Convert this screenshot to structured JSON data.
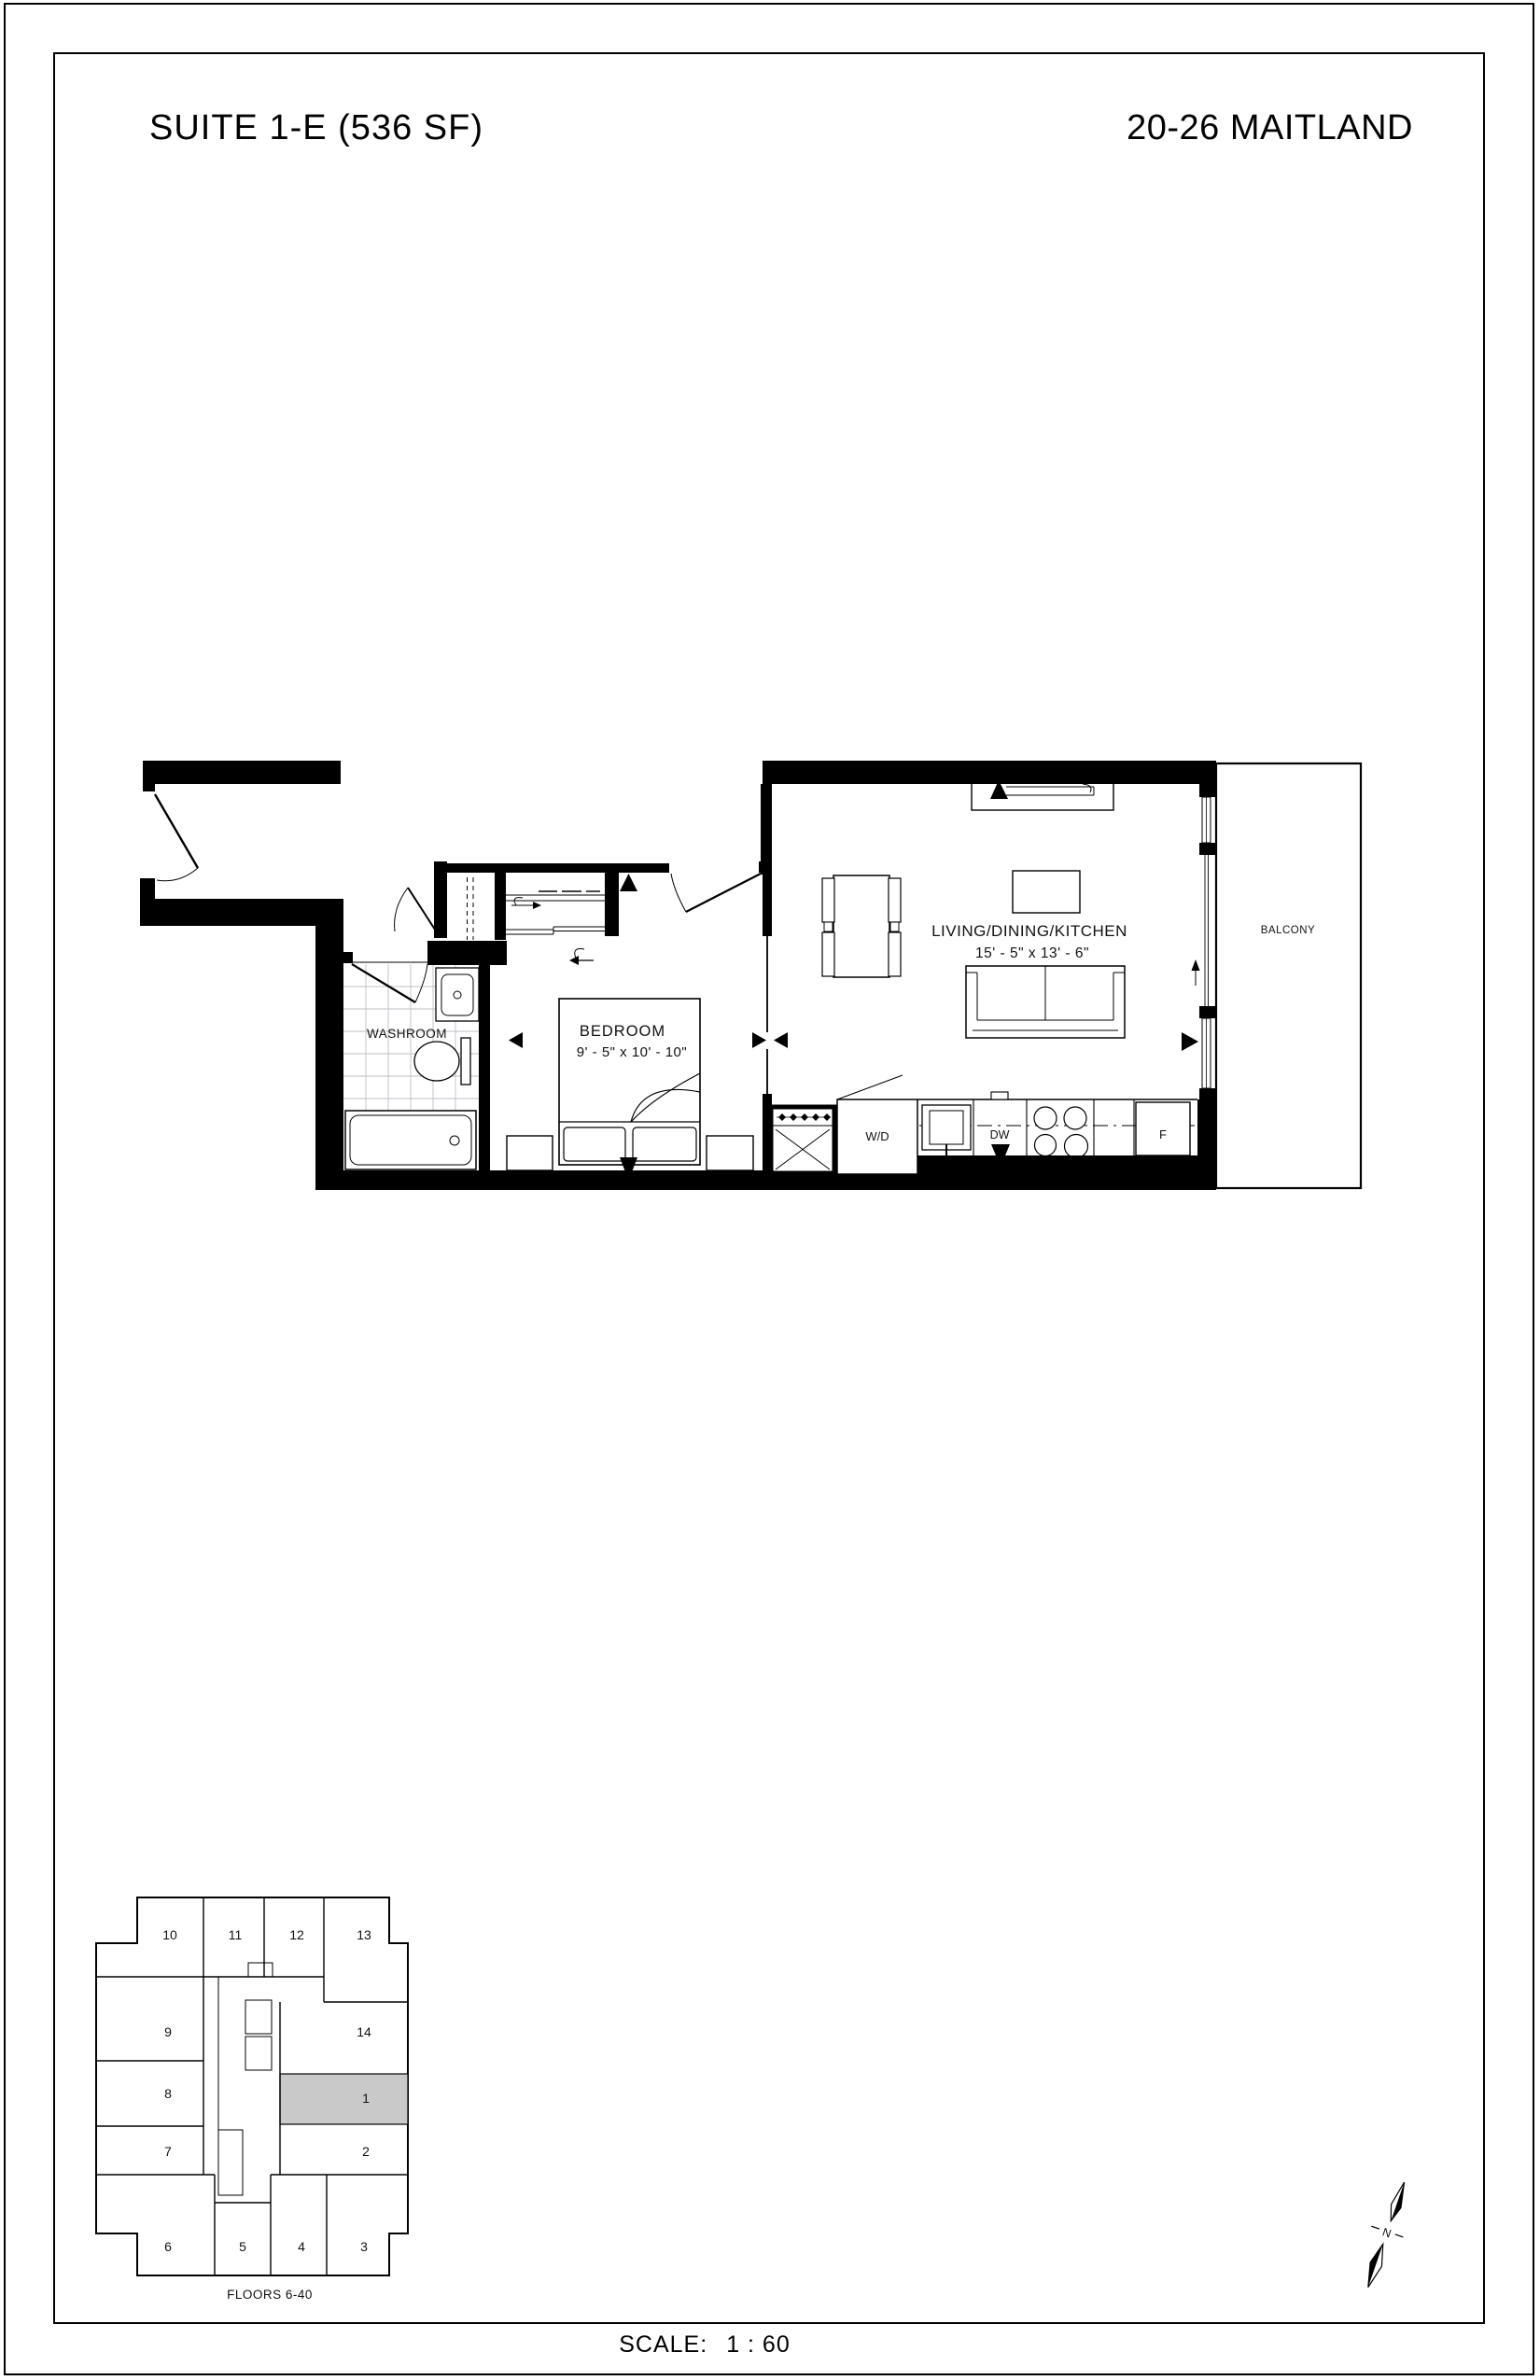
{
  "header": {
    "suite_title": "SUITE 1-E (536 SF)",
    "building_name": "20-26 MAITLAND"
  },
  "floorplan": {
    "washroom_label": "WASHROOM",
    "bedroom_label": "BEDROOM",
    "bedroom_dimensions": "9' - 5\" x  10' - 10\"",
    "living_label": "LIVING/DINING/KITCHEN",
    "living_dimensions": "15' - 5\" x  13' - 6\"",
    "balcony_label": "BALCONY",
    "washer_dryer_label": "W/D",
    "dishwasher_label": "DW",
    "fridge_label": "F"
  },
  "keyplan": {
    "units": [
      {
        "label": "1"
      },
      {
        "label": "2"
      },
      {
        "label": "3"
      },
      {
        "label": "4"
      },
      {
        "label": "5"
      },
      {
        "label": "6"
      },
      {
        "label": "7"
      },
      {
        "label": "8"
      },
      {
        "label": "9"
      },
      {
        "label": "10"
      },
      {
        "label": "11"
      },
      {
        "label": "12"
      },
      {
        "label": "13"
      },
      {
        "label": "14"
      }
    ],
    "highlighted_unit": "1",
    "highlight_color": "#c9c9c9",
    "floors_label": "FLOORS 6-40"
  },
  "compass": {
    "north_label": "N"
  },
  "footer": {
    "scale_label": "SCALE:",
    "scale_value": "1 : 60"
  }
}
